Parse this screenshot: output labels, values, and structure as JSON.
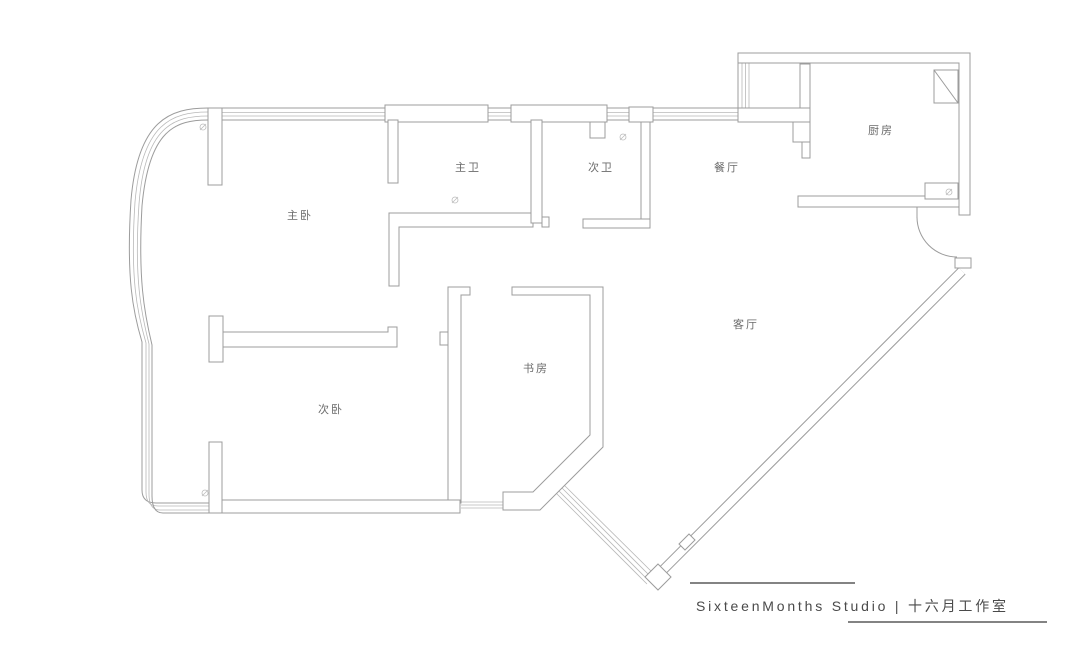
{
  "plan": {
    "rooms": {
      "master_bedroom": {
        "label": "主卧"
      },
      "master_bath": {
        "label": "主卫"
      },
      "second_bath": {
        "label": "次卫"
      },
      "dining": {
        "label": "餐厅"
      },
      "kitchen": {
        "label": "厨房"
      },
      "living": {
        "label": "客厅"
      },
      "study": {
        "label": "书房"
      },
      "second_bedroom": {
        "label": "次卧"
      }
    }
  },
  "footer": {
    "brand": "SixteenMonths Studio | 十六月工作室"
  },
  "colors": {
    "wall": "#9c9c9c",
    "window": "#b8b8b8",
    "label_text": "#6b6b6b",
    "footer_text": "#4a4a4a",
    "background": "#ffffff"
  }
}
